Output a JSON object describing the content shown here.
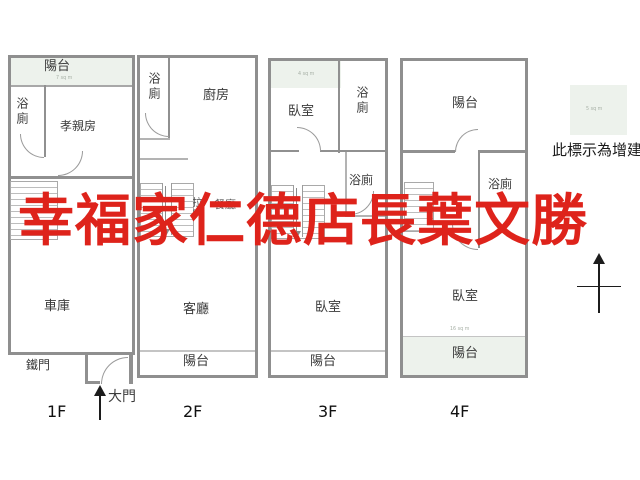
{
  "watermark": {
    "text": "幸福家仁德店長葉文勝",
    "color": "#de231b"
  },
  "legend": {
    "swatch_area": "5 sq m",
    "note": "此標示為增建"
  },
  "f1": {
    "tag": "1F",
    "balcony": "陽台",
    "balcony_area": "7 sq m",
    "bath": "浴廁",
    "elder_room": "孝親房",
    "garage": "車庫",
    "iron_door": "鐵門",
    "main_door": "大門"
  },
  "f2": {
    "tag": "2F",
    "bath": "浴廁",
    "kitchen": "廚房",
    "sliding_door": "拉門",
    "dining": "餐廳",
    "living_room": "客廳",
    "balcony": "陽台"
  },
  "f3": {
    "tag": "3F",
    "addition_area": "4 sq m",
    "bedroom_front": "臥室",
    "bath_upper": "浴廁",
    "bath_mid": "浴廁",
    "bedroom_rear": "臥室",
    "balcony": "陽台"
  },
  "f4": {
    "tag": "4F",
    "balcony_front": "陽台",
    "bath": "浴廁",
    "bedroom": "臥室",
    "balcony_area": "16 sq m",
    "balcony_rear": "陽台"
  }
}
